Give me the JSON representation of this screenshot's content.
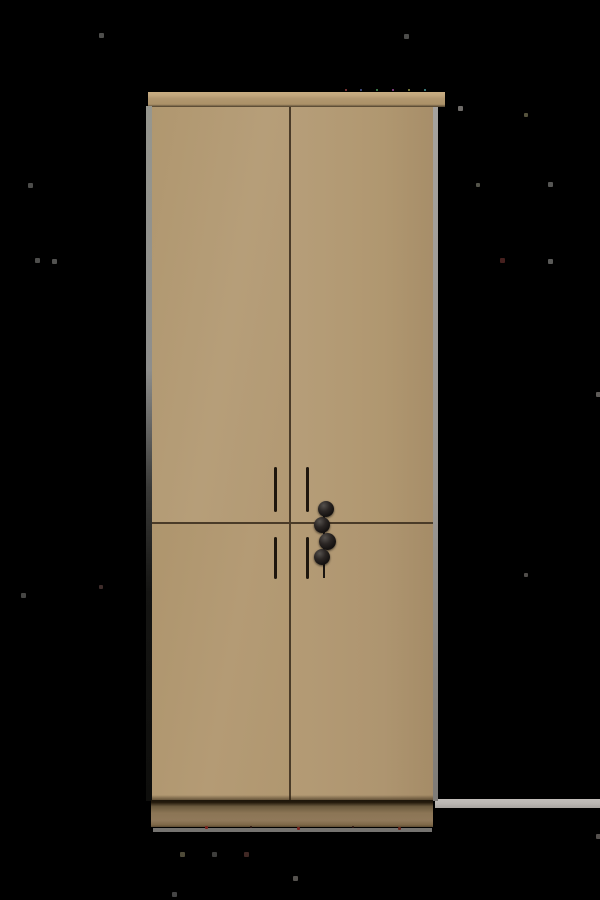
{
  "scene": {
    "subject": "Tall beige four-panel wardrobe cabinet with two vertical bar handles per column and four black ball knobs at the center, photographed on a solid black background",
    "object": "wardrobe-cabinet",
    "visible_text": ""
  },
  "palette": {
    "bg": "#000000",
    "door-face": "#b49c77",
    "seam": "#4a3b28",
    "cornice-face": "#b1976f",
    "cornice-hi": "#c9ae83",
    "side-gray": "#9b9894",
    "plinth": "#8b7555",
    "plinth-underline": "#8a8784",
    "floor-strip": "#b9b5b1",
    "handle": "#1e160d",
    "knob": "#141110"
  },
  "wardrobe": {
    "door_count": 4,
    "handle_count": 4,
    "knob_count": 4,
    "handles": [
      {
        "x": 274,
        "y": 467,
        "h": 45
      },
      {
        "x": 306,
        "y": 467,
        "h": 45
      },
      {
        "x": 274,
        "y": 537,
        "h": 42
      },
      {
        "x": 306,
        "y": 537,
        "h": 42
      }
    ],
    "knob_stem": {
      "x": 323,
      "y": 502,
      "h": 76
    },
    "knobs": [
      {
        "cx": 326,
        "cy": 509,
        "r": 8
      },
      {
        "cx": 322,
        "cy": 525,
        "r": 8
      },
      {
        "cx": 327,
        "cy": 541,
        "r": 8.5
      },
      {
        "cx": 322,
        "cy": 557,
        "r": 8
      }
    ]
  },
  "noise_specks": [
    {
      "x": 99,
      "y": 33,
      "s": 5,
      "c": "#4e4e4c"
    },
    {
      "x": 404,
      "y": 34,
      "s": 5,
      "c": "#4c4c4a"
    },
    {
      "x": 458,
      "y": 106,
      "s": 5,
      "c": "#6e6b68"
    },
    {
      "x": 524,
      "y": 113,
      "s": 4,
      "c": "#55523c"
    },
    {
      "x": 28,
      "y": 183,
      "s": 5,
      "c": "#4c4c4a"
    },
    {
      "x": 476,
      "y": 183,
      "s": 4,
      "c": "#54544a"
    },
    {
      "x": 548,
      "y": 182,
      "s": 5,
      "c": "#565654"
    },
    {
      "x": 35,
      "y": 258,
      "s": 5,
      "c": "#4e4e4c"
    },
    {
      "x": 52,
      "y": 259,
      "s": 5,
      "c": "#525250"
    },
    {
      "x": 500,
      "y": 258,
      "s": 5,
      "c": "#46201e"
    },
    {
      "x": 548,
      "y": 259,
      "s": 5,
      "c": "#5a5a58"
    },
    {
      "x": 596,
      "y": 392,
      "s": 5,
      "c": "#5e5b58"
    },
    {
      "x": 99,
      "y": 585,
      "s": 4,
      "c": "#3e2c2a"
    },
    {
      "x": 21,
      "y": 593,
      "s": 5,
      "c": "#464644"
    },
    {
      "x": 524,
      "y": 573,
      "s": 4,
      "c": "#504d4a"
    },
    {
      "x": 180,
      "y": 852,
      "s": 5,
      "c": "#4e4a38"
    },
    {
      "x": 212,
      "y": 852,
      "s": 5,
      "c": "#3e3e3c"
    },
    {
      "x": 244,
      "y": 852,
      "s": 5,
      "c": "#402824"
    },
    {
      "x": 293,
      "y": 876,
      "s": 5,
      "c": "#55524e"
    },
    {
      "x": 172,
      "y": 892,
      "s": 5,
      "c": "#454545"
    },
    {
      "x": 596,
      "y": 834,
      "s": 5,
      "c": "#54504d"
    },
    {
      "x": 345,
      "y": 89,
      "s": 2,
      "c": "#9a4040"
    },
    {
      "x": 360,
      "y": 89,
      "s": 2,
      "c": "#4a5a9a"
    },
    {
      "x": 376,
      "y": 89,
      "s": 2,
      "c": "#4a9a5a"
    },
    {
      "x": 392,
      "y": 89,
      "s": 2,
      "c": "#9a4a9a"
    },
    {
      "x": 408,
      "y": 89,
      "s": 2,
      "c": "#9a9a4a"
    },
    {
      "x": 424,
      "y": 89,
      "s": 2,
      "c": "#4a9a9a"
    },
    {
      "x": 205,
      "y": 826,
      "s": 3,
      "c": "#7a2420"
    },
    {
      "x": 250,
      "y": 826,
      "s": 2,
      "c": "#2a1410"
    },
    {
      "x": 297,
      "y": 827,
      "s": 3,
      "c": "#7a2420"
    },
    {
      "x": 352,
      "y": 826,
      "s": 2,
      "c": "#2a1410"
    },
    {
      "x": 398,
      "y": 827,
      "s": 3,
      "c": "#6a2a20"
    }
  ]
}
